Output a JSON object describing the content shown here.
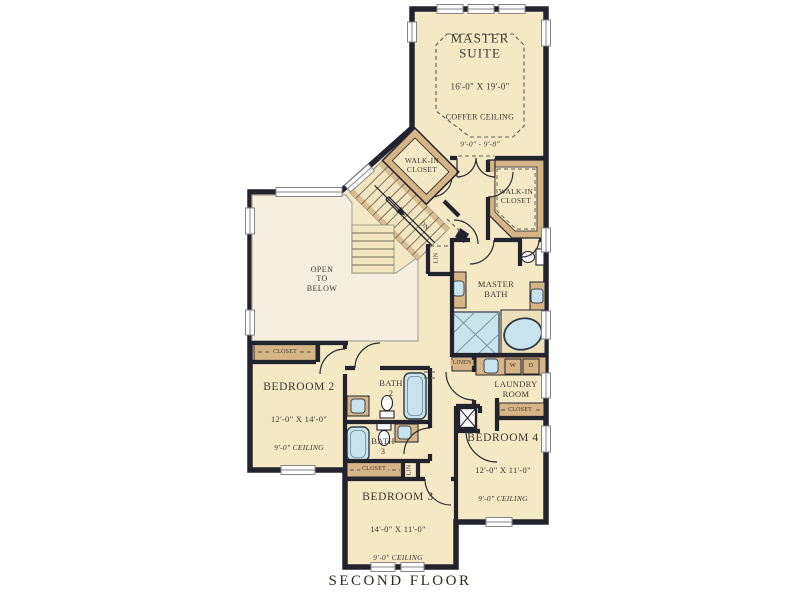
{
  "plan_title": "SECOND FLOOR",
  "colors": {
    "wall": "#23232e",
    "room_fill": "#f5e8c5",
    "open_area_fill": "#f6efdf",
    "millwork_tan": "#d5b586",
    "fixture_blue": "#c9e3ed",
    "text": "#3c382f"
  },
  "rooms": {
    "master_suite": {
      "name": "MASTER\nSUITE",
      "dims": "16'-0\" X 19'-0\"",
      "ceiling": "COFFER CEILING",
      "ceiling_height": "9'-0\" - 9'-8\""
    },
    "walk_in_closet_1": {
      "name": "WALK-IN\nCLOSET"
    },
    "walk_in_closet_2": {
      "name": "WALK-IN\nCLOSET"
    },
    "open_to_below": {
      "name": "OPEN\nTO\nBELOW"
    },
    "master_bath": {
      "name": "MASTER\nBATH"
    },
    "laundry": {
      "name": "LAUNDRY\nROOM"
    },
    "bath_2": {
      "name": "BATH\n2"
    },
    "bath_3": {
      "name": "BATH\n3"
    },
    "bedroom_2": {
      "name": "BEDROOM 2",
      "dims": "12'-0\" X 14'-0\"",
      "ceiling": "9'-0\" CEILING"
    },
    "bedroom_3": {
      "name": "BEDROOM 3",
      "dims": "14'-0\" X 11'-0\"",
      "ceiling": "9'-0\" CEILING"
    },
    "bedroom_4": {
      "name": "BEDROOM 4",
      "dims": "12'-0\" X 11'-0\"",
      "ceiling": "9'-0\" CEILING"
    }
  },
  "labels": {
    "closet": "CLOSET",
    "linen": "LINEN",
    "lin": "LIN",
    "down": "DN",
    "washer": "W",
    "dryer": "D"
  }
}
